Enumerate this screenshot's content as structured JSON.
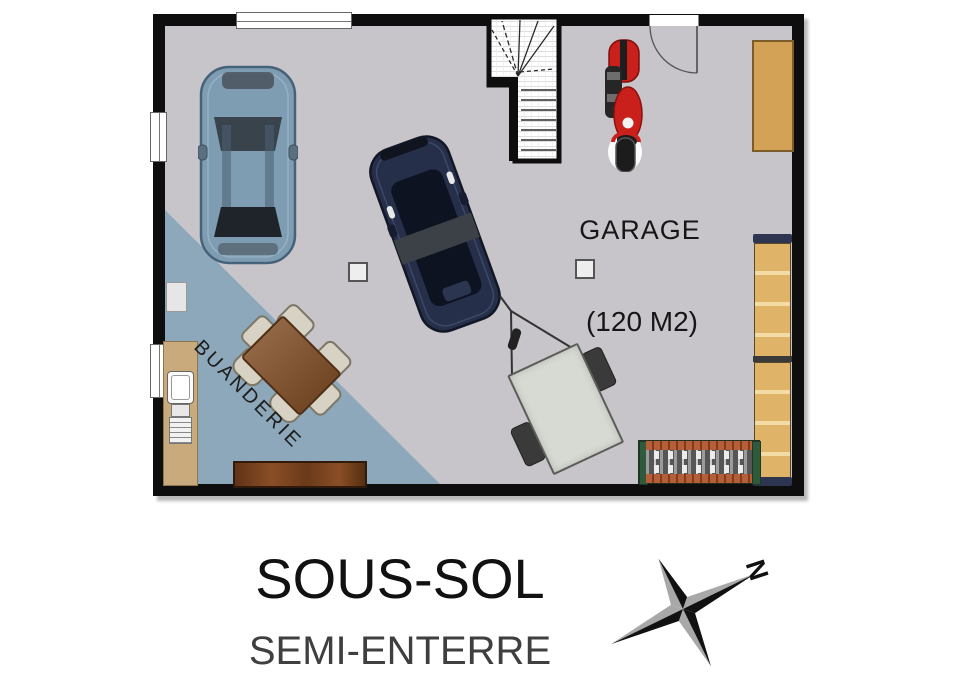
{
  "plan": {
    "rooms": {
      "garage": {
        "label": "GARAGE",
        "area": "(120 M2)"
      },
      "laundry": {
        "label": "BUANDERIE"
      }
    }
  },
  "footer": {
    "title": "SOUS-SOL",
    "subtitle": "SEMI-ENTERRE"
  },
  "compass": {
    "north_label": "N"
  },
  "colors": {
    "wall": "#0e0e0e",
    "floor": "#c8c5ca",
    "laundry_zone": "#8da8ba",
    "wood_light": "#d4a257",
    "wood_counter": "#c9aa7c",
    "shelf": "#dfb469",
    "table": "#82512a",
    "bench": "#6b3a1a",
    "car_blue": "#7e9cb2",
    "car_dark": "#262f49",
    "moto_red": "#c9201b",
    "trailer": "#d7d9d3",
    "rack_rail": "#b65f36",
    "compass_black": "#111111",
    "compass_gray": "#a8a8a8"
  },
  "objects": {
    "vehicles": [
      "blue-car",
      "dark-car",
      "trailer",
      "motorcycle"
    ],
    "furniture": [
      "staircase",
      "dining-table-with-chairs",
      "laundry-counter-sink",
      "wall-bench",
      "wood-board",
      "shelving-unit",
      "storage-rack"
    ],
    "architecture": [
      "walls",
      "window",
      "entry-door",
      "support-post",
      "compass-rose"
    ]
  }
}
